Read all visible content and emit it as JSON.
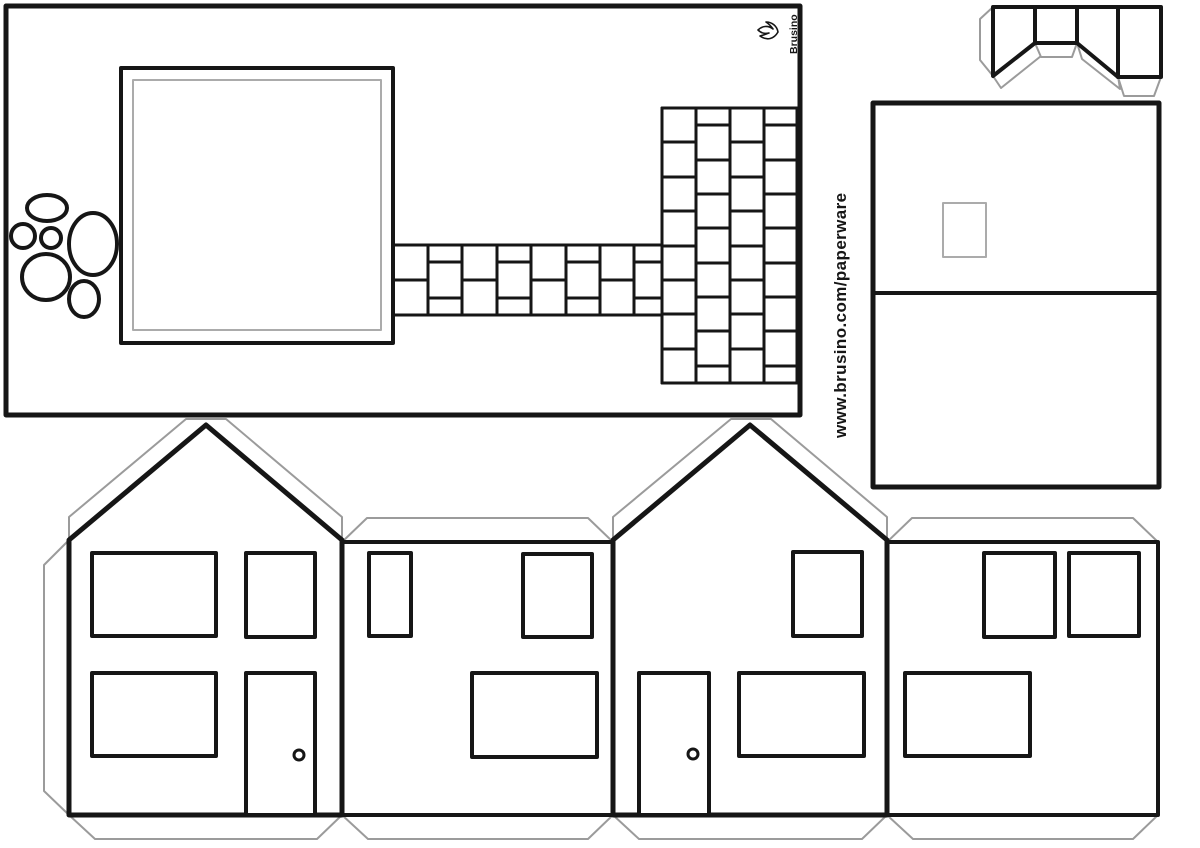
{
  "canvas": {
    "width": 1200,
    "height": 848,
    "background": "#ffffff"
  },
  "colors": {
    "line": "#161616",
    "tab": "#9b9b9b",
    "soft": "#ababab",
    "white": "#ffffff"
  },
  "branding": {
    "logo_text": "Brusino",
    "logo_icon": "flame-icon",
    "url_text": "www.brusino.com/paperware"
  },
  "brick_paths": {
    "horizontal": {
      "x0": 393,
      "x1": 662,
      "y0": 245,
      "y1": 315,
      "cols": [
        393,
        428,
        462,
        497,
        531,
        566,
        600,
        634,
        662
      ],
      "mid_a": 280,
      "mid_b": [
        262,
        298
      ]
    },
    "vertical": {
      "x0": 662,
      "x1": 797,
      "y0": 108,
      "y1": 383,
      "cols": [
        662,
        696,
        730,
        764,
        797
      ],
      "joints_a": [
        142,
        177,
        211,
        246,
        280,
        314,
        349
      ],
      "joints_b": [
        125,
        160,
        194,
        228,
        263,
        297,
        331,
        366
      ]
    }
  },
  "shapes": [
    {
      "t": "rect",
      "name": "page-background",
      "a": {
        "x": 0,
        "y": 0,
        "width": 1200,
        "height": 848
      },
      "f": "white",
      "s": "none",
      "sw": 0
    },
    {
      "t": "rect",
      "name": "base-plate",
      "a": {
        "x": 6,
        "y": 6,
        "width": 794,
        "height": 409
      },
      "s": "line",
      "sw": 5,
      "f": "white"
    },
    {
      "t": "rect",
      "name": "house-footprint-outline",
      "a": {
        "x": 121,
        "y": 68,
        "width": 272,
        "height": 275
      },
      "s": "line",
      "sw": 4,
      "f": "white"
    },
    {
      "t": "rect",
      "name": "house-footprint-inner-line",
      "a": {
        "x": 133,
        "y": 80,
        "width": 248,
        "height": 250
      },
      "s": "soft",
      "sw": 2,
      "f": "none"
    },
    {
      "t": "ellipse",
      "name": "stone-1",
      "a": {
        "cx": 47,
        "cy": 208,
        "rx": 20,
        "ry": 13
      },
      "s": "line",
      "sw": 4,
      "f": "white"
    },
    {
      "t": "ellipse",
      "name": "stone-2",
      "a": {
        "cx": 23,
        "cy": 236,
        "rx": 12,
        "ry": 12
      },
      "s": "line",
      "sw": 4,
      "f": "white"
    },
    {
      "t": "ellipse",
      "name": "stone-3",
      "a": {
        "cx": 51,
        "cy": 238,
        "rx": 10,
        "ry": 10
      },
      "s": "line",
      "sw": 4,
      "f": "white"
    },
    {
      "t": "ellipse",
      "name": "stone-4",
      "a": {
        "cx": 93,
        "cy": 244,
        "rx": 24,
        "ry": 31
      },
      "s": "line",
      "sw": 4,
      "f": "white"
    },
    {
      "t": "ellipse",
      "name": "stone-5",
      "a": {
        "cx": 46,
        "cy": 277,
        "rx": 24,
        "ry": 23
      },
      "s": "line",
      "sw": 4,
      "f": "white"
    },
    {
      "t": "ellipse",
      "name": "stone-6",
      "a": {
        "cx": 84,
        "cy": 299,
        "rx": 15,
        "ry": 18
      },
      "s": "line",
      "sw": 4,
      "f": "white"
    },
    {
      "t": "rect",
      "name": "roof-panel",
      "a": {
        "x": 873,
        "y": 103,
        "width": 286,
        "height": 384
      },
      "s": "line",
      "sw": 5,
      "f": "white"
    },
    {
      "t": "line",
      "name": "roof-ridge-fold-line",
      "a": {
        "x1": 873,
        "y1": 293,
        "x2": 1159,
        "y2": 293
      },
      "s": "line",
      "sw": 4
    },
    {
      "t": "rect",
      "name": "chimney-hole",
      "a": {
        "x": 943,
        "y": 203,
        "width": 43,
        "height": 54
      },
      "s": "soft",
      "sw": 2,
      "f": "none"
    },
    {
      "t": "polygon",
      "name": "chimney-glue-tab-left",
      "a": {
        "points": "993,7 980,19 980,60 993,76"
      },
      "s": "tab",
      "sw": 2,
      "f": "white"
    },
    {
      "t": "polygon",
      "name": "chimney-glue-tab-a",
      "a": {
        "points": "993,76 1001,88 1041,56 1035,43"
      },
      "s": "tab",
      "sw": 2,
      "f": "white"
    },
    {
      "t": "polygon",
      "name": "chimney-glue-tab-b",
      "a": {
        "points": "1035,43 1041,57 1072,57 1077,43"
      },
      "s": "tab",
      "sw": 2,
      "f": "white"
    },
    {
      "t": "polygon",
      "name": "chimney-glue-tab-c",
      "a": {
        "points": "1077,43 1082,59 1120,89 1118,76"
      },
      "s": "tab",
      "sw": 2,
      "f": "white"
    },
    {
      "t": "polygon",
      "name": "chimney-glue-tab-d",
      "a": {
        "points": "1118,77 1124,96 1154,96 1161,77"
      },
      "s": "tab",
      "sw": 2,
      "f": "white"
    },
    {
      "t": "polygon",
      "name": "chimney-outline",
      "a": {
        "points": "993,7 1161,7 1161,77 1118,77 1077,43 1035,43 993,76"
      },
      "s": "line",
      "sw": 4,
      "f": "white"
    },
    {
      "t": "line",
      "name": "chimney-fold-line-1",
      "a": {
        "x1": 1035,
        "y1": 7,
        "x2": 1035,
        "y2": 43
      },
      "s": "line",
      "sw": 4
    },
    {
      "t": "line",
      "name": "chimney-fold-line-2",
      "a": {
        "x1": 1077,
        "y1": 7,
        "x2": 1077,
        "y2": 43
      },
      "s": "line",
      "sw": 4
    },
    {
      "t": "line",
      "name": "chimney-fold-line-3",
      "a": {
        "x1": 1118,
        "y1": 7,
        "x2": 1118,
        "y2": 77
      },
      "s": "line",
      "sw": 4
    },
    {
      "t": "polygon",
      "name": "wall-glue-tab-left-side",
      "a": {
        "points": "69,540 44,565 44,791 69,815"
      },
      "s": "tab",
      "sw": 2,
      "f": "white"
    },
    {
      "t": "polygon",
      "name": "gable-glue-tab-left",
      "a": {
        "points": "69,540 69,517 186,419 226,419 342,517 342,540 206,426"
      },
      "s": "tab",
      "sw": 2,
      "f": "white"
    },
    {
      "t": "polygon",
      "name": "wall-glue-tab-top-1",
      "a": {
        "points": "342,542 367,518 588,518 613,542"
      },
      "s": "tab",
      "sw": 2,
      "f": "white"
    },
    {
      "t": "polygon",
      "name": "gable-glue-tab-right",
      "a": {
        "points": "613,540 613,517 731,419 771,419 887,517 887,540 750,426"
      },
      "s": "tab",
      "sw": 2,
      "f": "white"
    },
    {
      "t": "polygon",
      "name": "wall-glue-tab-top-2",
      "a": {
        "points": "887,542 912,518 1133,518 1158,542"
      },
      "s": "tab",
      "sw": 2,
      "f": "white"
    },
    {
      "t": "polygon",
      "name": "wall-glue-tab-bottom-1",
      "a": {
        "points": "69,815 95,839 317,839 342,815"
      },
      "s": "tab",
      "sw": 2,
      "f": "white"
    },
    {
      "t": "polygon",
      "name": "wall-glue-tab-bottom-2",
      "a": {
        "points": "342,815 368,839 588,839 613,815"
      },
      "s": "tab",
      "sw": 2,
      "f": "white"
    },
    {
      "t": "polygon",
      "name": "wall-glue-tab-bottom-3",
      "a": {
        "points": "613,815 639,839 862,839 887,815"
      },
      "s": "tab",
      "sw": 2,
      "f": "white"
    },
    {
      "t": "polygon",
      "name": "wall-glue-tab-bottom-4",
      "a": {
        "points": "887,815 913,839 1133,839 1158,815"
      },
      "s": "tab",
      "sw": 2,
      "f": "white"
    },
    {
      "t": "rect",
      "name": "side-wall-1",
      "a": {
        "x": 342,
        "y": 542,
        "width": 271,
        "height": 273
      },
      "s": "line",
      "sw": 4,
      "f": "white"
    },
    {
      "t": "rect",
      "name": "side-wall-2",
      "a": {
        "x": 887,
        "y": 542,
        "width": 271,
        "height": 273
      },
      "s": "line",
      "sw": 4,
      "f": "white"
    },
    {
      "t": "polygon",
      "name": "gable-wall-1",
      "a": {
        "points": "69,540 206,425 342,540 342,815 69,815"
      },
      "s": "line",
      "sw": 5,
      "f": "white"
    },
    {
      "t": "polygon",
      "name": "gable-wall-2",
      "a": {
        "points": "613,540 750,425 887,540 887,815 613,815"
      },
      "s": "line",
      "sw": 5,
      "f": "white"
    },
    {
      "t": "rect",
      "name": "gable1-window-upper-left",
      "a": {
        "x": 92,
        "y": 553,
        "width": 124,
        "height": 83
      },
      "s": "line",
      "sw": 4,
      "f": "white"
    },
    {
      "t": "rect",
      "name": "gable1-window-upper-right",
      "a": {
        "x": 246,
        "y": 553,
        "width": 69,
        "height": 84
      },
      "s": "line",
      "sw": 4,
      "f": "white"
    },
    {
      "t": "rect",
      "name": "gable1-window-lower-left",
      "a": {
        "x": 92,
        "y": 673,
        "width": 124,
        "height": 83
      },
      "s": "line",
      "sw": 4,
      "f": "white"
    },
    {
      "t": "rect",
      "name": "gable1-door",
      "a": {
        "x": 246,
        "y": 673,
        "width": 69,
        "height": 142
      },
      "s": "line",
      "sw": 4,
      "f": "white"
    },
    {
      "t": "circle",
      "name": "gable1-door-knob",
      "a": {
        "cx": 299,
        "cy": 755,
        "r": 5
      },
      "s": "line",
      "sw": 3,
      "f": "white"
    },
    {
      "t": "rect",
      "name": "side1-window-narrow",
      "a": {
        "x": 369,
        "y": 553,
        "width": 42,
        "height": 83
      },
      "s": "line",
      "sw": 4,
      "f": "white"
    },
    {
      "t": "rect",
      "name": "side1-window-upper-right",
      "a": {
        "x": 523,
        "y": 554,
        "width": 69,
        "height": 83
      },
      "s": "line",
      "sw": 4,
      "f": "white"
    },
    {
      "t": "rect",
      "name": "side1-window-wide",
      "a": {
        "x": 472,
        "y": 673,
        "width": 125,
        "height": 84
      },
      "s": "line",
      "sw": 4,
      "f": "white"
    },
    {
      "t": "rect",
      "name": "gable2-door",
      "a": {
        "x": 639,
        "y": 673,
        "width": 70,
        "height": 142
      },
      "s": "line",
      "sw": 4,
      "f": "white"
    },
    {
      "t": "circle",
      "name": "gable2-door-knob",
      "a": {
        "cx": 693,
        "cy": 754,
        "r": 5
      },
      "s": "line",
      "sw": 3,
      "f": "white"
    },
    {
      "t": "rect",
      "name": "gable2-window-upper-right",
      "a": {
        "x": 793,
        "y": 552,
        "width": 69,
        "height": 84
      },
      "s": "line",
      "sw": 4,
      "f": "white"
    },
    {
      "t": "rect",
      "name": "gable2-window-wide",
      "a": {
        "x": 739,
        "y": 673,
        "width": 125,
        "height": 83
      },
      "s": "line",
      "sw": 4,
      "f": "white"
    },
    {
      "t": "rect",
      "name": "side2-window-upper-left",
      "a": {
        "x": 984,
        "y": 553,
        "width": 71,
        "height": 84
      },
      "s": "line",
      "sw": 4,
      "f": "white"
    },
    {
      "t": "rect",
      "name": "side2-window-upper-right",
      "a": {
        "x": 1069,
        "y": 553,
        "width": 70,
        "height": 83
      },
      "s": "line",
      "sw": 4,
      "f": "white"
    },
    {
      "t": "rect",
      "name": "side2-window-wide",
      "a": {
        "x": 905,
        "y": 673,
        "width": 125,
        "height": 83
      },
      "s": "line",
      "sw": 4,
      "f": "white"
    },
    {
      "t": "path",
      "name": "flame-icon",
      "a": {
        "d": "M 0 9 C -7 5 -9 -2 -4 -9 C -3 -5 -2 -3 -1 0 C -2 -5 -1 -8 2 -11 C 6 -7 7 -1 3 4 C 6 2 8 0 10 -3 C 10 3 6 8 0 9 Z",
        "transform": "translate(769,32) rotate(-90)"
      },
      "s": "line",
      "sw": 1.6,
      "f": "white"
    },
    {
      "t": "text",
      "name": "brusino-logo-text",
      "a": {
        "x": 0,
        "y": 0,
        "transform": "translate(797,54) rotate(-90)",
        "font-size": "10.5"
      },
      "bind": "branding.logo_text"
    },
    {
      "t": "text",
      "name": "website-url-text",
      "cls": "url-text",
      "a": {
        "x": 0,
        "y": 0,
        "transform": "translate(846,438) rotate(-90)",
        "font-size": "17"
      },
      "bind": "branding.url_text"
    }
  ]
}
